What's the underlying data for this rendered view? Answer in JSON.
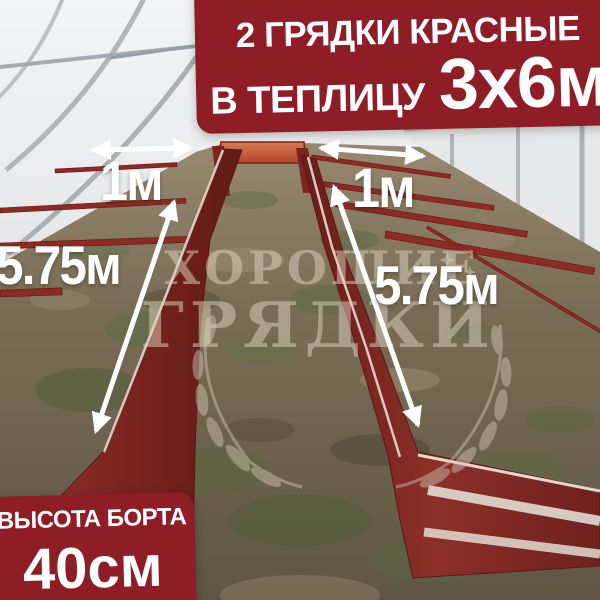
{
  "top_banner": {
    "line1": "2 ГРЯДКИ КРАСНЫЕ",
    "line2_prefix": "В ТЕПЛИЦУ",
    "line2_value": "3х6м"
  },
  "bottom_banner": {
    "label": "ВЫСОТА БОРТА",
    "value": "40см"
  },
  "measurements": {
    "left_bed_width": "1м",
    "right_bed_width": "1м",
    "left_bed_length": "5.75м",
    "right_bed_length": "5.75м"
  },
  "watermark": {
    "line1": "ХОРОШИЕ",
    "line2": "ГРЯДКИ"
  },
  "icons": {
    "width_arrow_left": "double-headed-horizontal-arrow",
    "width_arrow_right": "double-headed-horizontal-arrow",
    "length_arrow_left": "double-headed-diagonal-arrow",
    "length_arrow_right": "double-headed-diagonal-arrow",
    "watermark_wreath": "laurel-wreath",
    "watermark_stars": "small-stars"
  },
  "colors": {
    "banner_red": "#8e1d26",
    "bed_red": "#7e2421",
    "bed_end_orange": "#c25a38",
    "text_white": "#ffffff",
    "watermark_beige": "#d3cab8",
    "galvanized_silver": "#c7cacd",
    "ground_brown": "#6f6450"
  }
}
